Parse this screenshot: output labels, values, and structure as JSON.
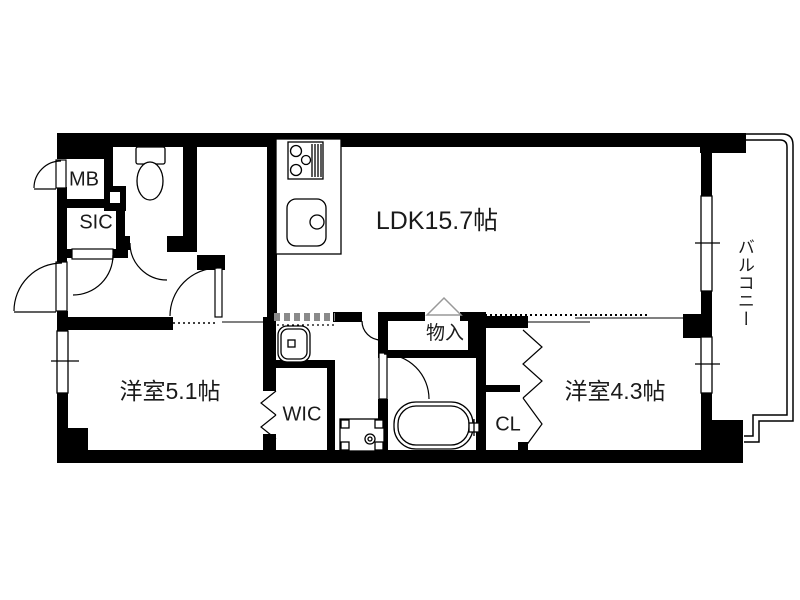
{
  "floor_plan": {
    "rooms": {
      "ldk": {
        "label": "LDK15.7帖"
      },
      "bedroom1": {
        "label": "洋室5.1帖"
      },
      "bedroom2": {
        "label": "洋室4.3帖"
      },
      "balcony": {
        "label": "バルコニー"
      },
      "storage": {
        "label": "物入"
      },
      "wic": {
        "label": "WIC"
      },
      "cl": {
        "label": "CL"
      },
      "sic": {
        "label": "SIC"
      },
      "mb": {
        "label": "MB"
      }
    },
    "colors": {
      "wall": "#000000",
      "background": "#ffffff",
      "sliding_hatch": "#8a8a8a"
    }
  }
}
